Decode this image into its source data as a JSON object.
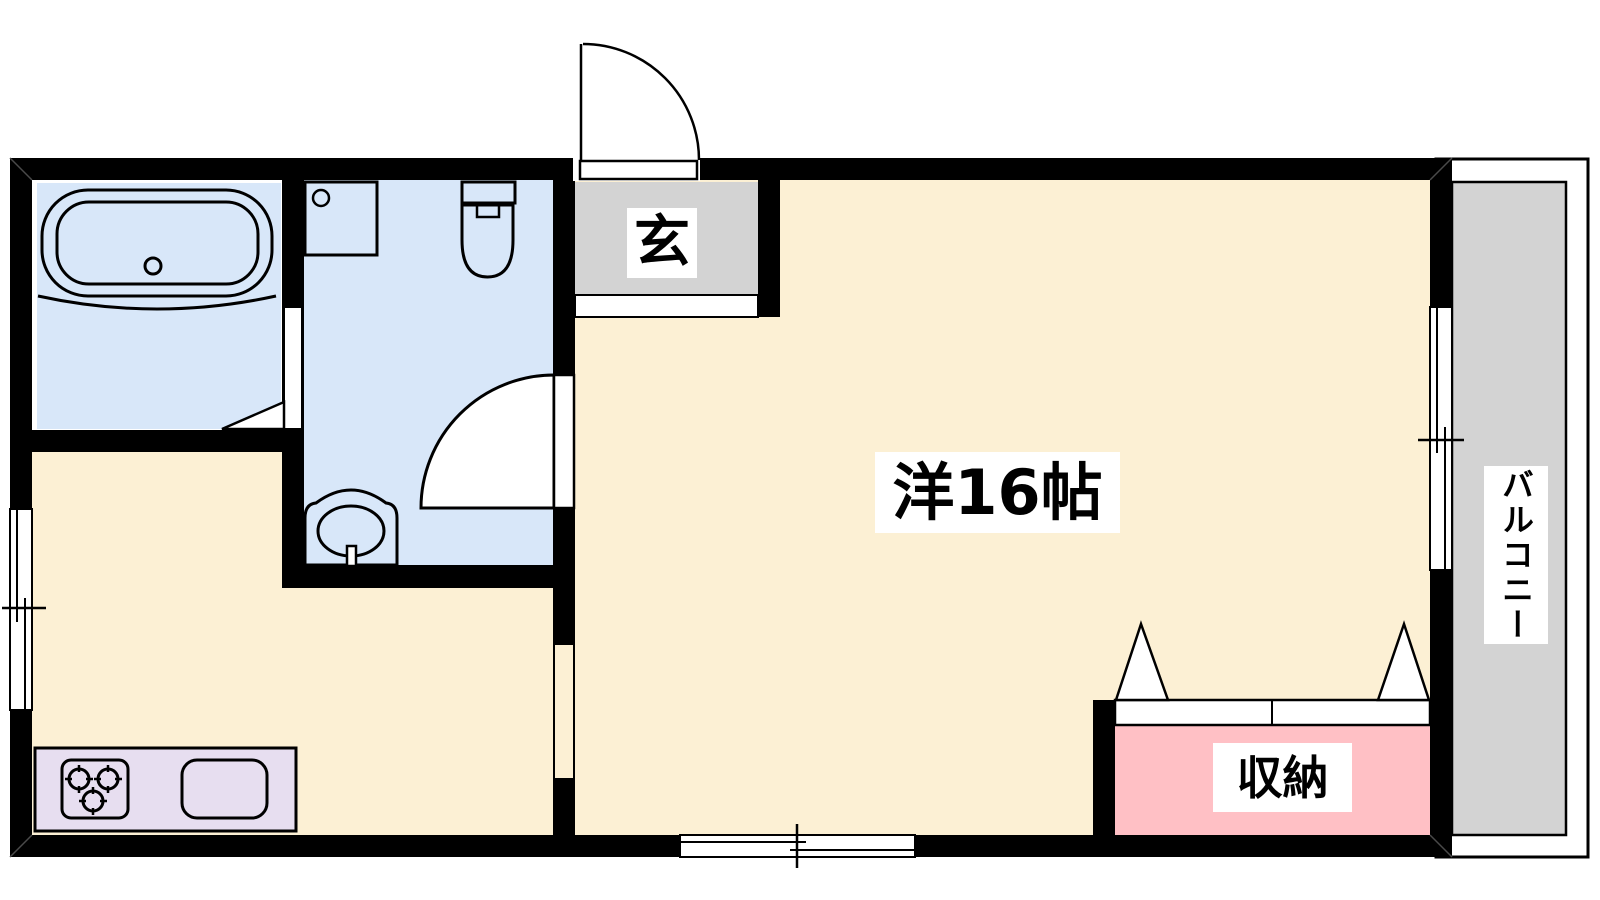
{
  "plan": {
    "type": "apartment-floor-plan",
    "labels": {
      "entrance": "玄",
      "main_room": "洋16帖",
      "storage": "収納",
      "balcony": "バルコニー"
    },
    "colors": {
      "wall": "#000000",
      "outline": "#000000",
      "main_room_floor": "#fcf0d4",
      "wet_area_floor": "#d8e7f9",
      "entrance_floor": "#d3d3d3",
      "balcony_floor": "#d3d3d3",
      "storage_floor": "#ffc0c5",
      "kitchen_counter": "#e7def0",
      "label_background": "#ffffff",
      "text": "#000000"
    },
    "fixtures": [
      "bathtub-icon",
      "washing-machine-pan-icon",
      "toilet-icon",
      "wash-basin-icon",
      "gas-stove-icon",
      "kitchen-sink-icon",
      "entrance-door-swing-icon",
      "bathroom-folding-door-icon",
      "washroom-door-swing-icon",
      "storage-folding-door-icon",
      "sliding-window-icon-left",
      "sliding-window-icon-bottom",
      "sliding-window-icon-balcony"
    ]
  }
}
